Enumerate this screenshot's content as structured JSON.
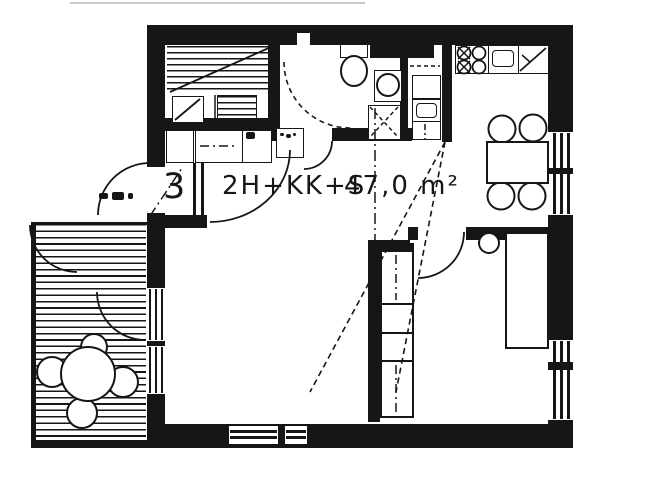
{
  "plan": {
    "apartment_number": "3",
    "layout_code": "2H+KK+S",
    "area_label": "47,0 m²"
  },
  "colors": {
    "ink": "#161616",
    "background": "#ffffff"
  }
}
